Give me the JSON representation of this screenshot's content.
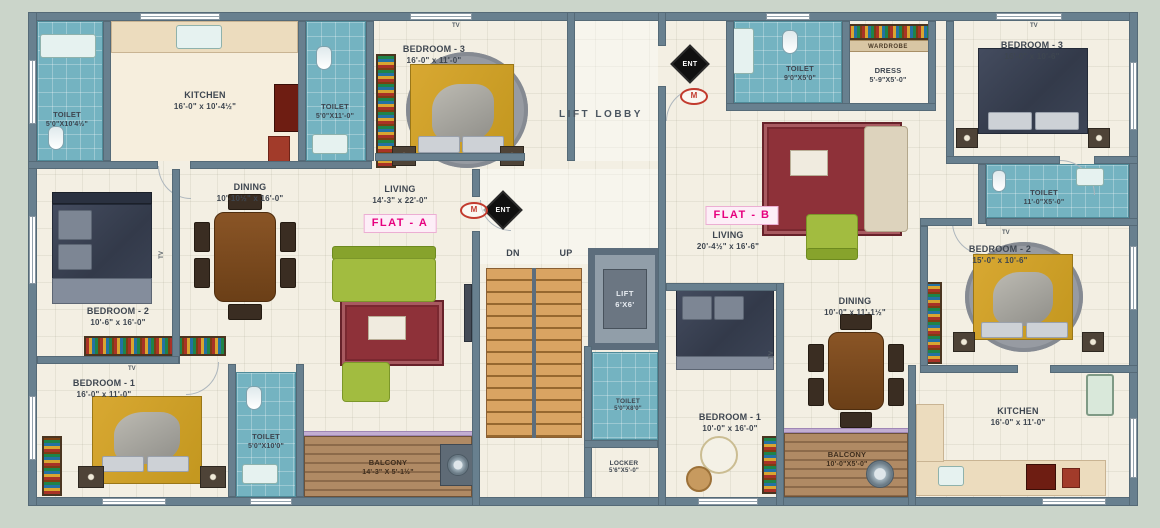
{
  "palette": {
    "wall": "#68808f",
    "toilet_blue": "#74b3c1",
    "balcony_wood": "#a98263",
    "stair_wood": "#d9a462",
    "floor": "#f3efe3",
    "background": "#cbd5ca",
    "flat_badge_pink": "#e6007e"
  },
  "flat_a": {
    "badge": "FLAT - A",
    "toilet1": {
      "name": "TOILET",
      "dims": "5'0\"X10'4½\""
    },
    "kitchen": {
      "name": "KITCHEN",
      "dims": "16'-0\" x 10'-4½\""
    },
    "toilet2": {
      "name": "TOILET",
      "dims": "5'0\"X11'-0\""
    },
    "bed3": {
      "name": "BEDROOM - 3",
      "dims": "16'-0\" x 11'-0\""
    },
    "dining": {
      "name": "DINING",
      "dims": "10'-10½\" x 16'-0\""
    },
    "living": {
      "name": "LIVING",
      "dims": "14'-3\" x 22'-0\""
    },
    "bed2": {
      "name": "BEDROOM - 2",
      "dims": "10'-6\" x 16'-0\""
    },
    "bed1": {
      "name": "BEDROOM - 1",
      "dims": "16'-0\" x 11'-0\""
    },
    "toilet3": {
      "name": "TOILET",
      "dims": "5'0\"X10'0\""
    },
    "balcony": {
      "name": "BALCONY",
      "dims": "14'-3\" X 5'-1½\""
    }
  },
  "core": {
    "lobby": "LIFT LOBBY",
    "dn": "DN",
    "up": "UP",
    "ent": "ENT",
    "m": "M",
    "lift": {
      "name": "LIFT",
      "dims": "6'X6'"
    },
    "toilet": {
      "name": "TOILET",
      "dims": "5'0\"X8'0\""
    },
    "locker": {
      "name": "LOCKER",
      "dims": "5'6\"X5'-0\""
    }
  },
  "flat_b": {
    "badge": "FLAT - B",
    "toilet1": {
      "name": "TOILET",
      "dims": "9'0\"X5'0\""
    },
    "wardrobe": "WARDROBE",
    "dress": {
      "name": "DRESS",
      "dims": "5'-9\"X5'-0\""
    },
    "bed3": {
      "name": "BEDROOM - 3",
      "dims": "16'-0\" x 10'-6\""
    },
    "living": {
      "name": "LIVING",
      "dims": "20'-4½\" x 16'-6\""
    },
    "toilet2": {
      "name": "TOILET",
      "dims": "11'-0\"X5'-0\""
    },
    "bed2": {
      "name": "BEDROOM - 2",
      "dims": "15'-0\" x 10'-6\""
    },
    "dining": {
      "name": "DINING",
      "dims": "10'-0\" x 11'-1½\""
    },
    "bed1": {
      "name": "BEDROOM - 1",
      "dims": "10'-0\" x 16'-0\""
    },
    "balcony": {
      "name": "BALCONY",
      "dims": "10'-0\"X5'-0\""
    },
    "kitchen": {
      "name": "KITCHEN",
      "dims": "16'-0\" x 11'-0\""
    }
  },
  "misc": {
    "tv": "TV"
  }
}
